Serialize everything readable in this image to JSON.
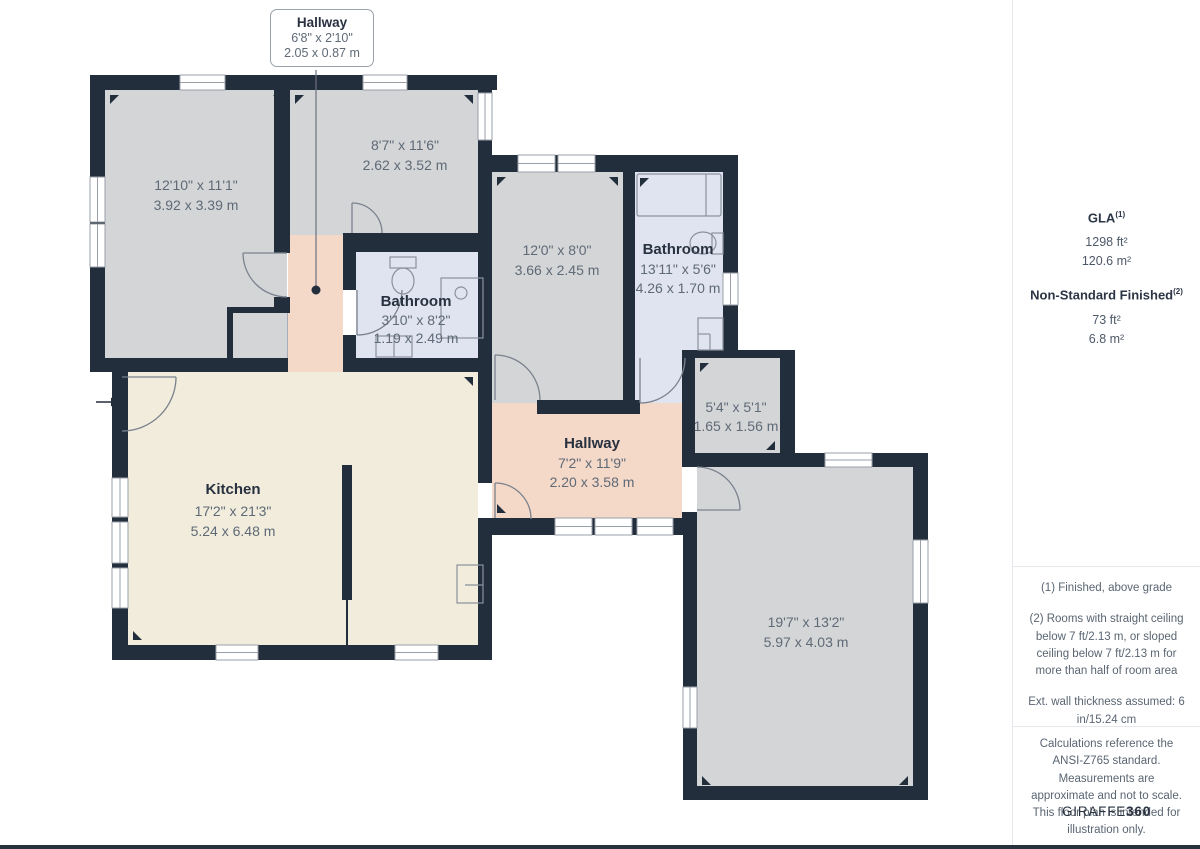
{
  "callout": {
    "name": "Hallway",
    "imperial": "6'8\" x 2'10\"",
    "metric": "2.05 x 0.87 m"
  },
  "rooms": [
    {
      "id": "room-top-left",
      "name": "",
      "imperial": "12'10\" x 11'1\"",
      "metric": "3.92 x 3.39 m"
    },
    {
      "id": "room-top-middle",
      "name": "",
      "imperial": "8'7\" x 11'6\"",
      "metric": "2.62 x 3.52 m"
    },
    {
      "id": "room-middle",
      "name": "",
      "imperial": "12'0\" x 8'0\"",
      "metric": "3.66 x 2.45 m"
    },
    {
      "id": "bathroom-large",
      "name": "Bathroom",
      "imperial": "13'11\" x 5'6\"",
      "metric": "4.26 x 1.70 m"
    },
    {
      "id": "bathroom-small",
      "name": "Bathroom",
      "imperial": "3'10\" x 8'2\"",
      "metric": "1.19 x 2.49 m"
    },
    {
      "id": "storage",
      "name": "",
      "imperial": "5'4\" x 5'1\"",
      "metric": "1.65 x 1.56 m"
    },
    {
      "id": "kitchen",
      "name": "Kitchen",
      "imperial": "17'2\" x 21'3\"",
      "metric": "5.24 x 6.48 m"
    },
    {
      "id": "hallway-main",
      "name": "Hallway",
      "imperial": "7'2\" x 11'9\"",
      "metric": "2.20 x 3.58 m"
    },
    {
      "id": "room-bottom-right",
      "name": "",
      "imperial": "19'7\" x 13'2\"",
      "metric": "5.97 x 4.03 m"
    }
  ],
  "sidebar": {
    "gla": {
      "label": "GLA",
      "sup": "(1)",
      "values": [
        "1298 ft²",
        "120.6 m²"
      ]
    },
    "nsf": {
      "label": "Non-Standard Finished",
      "sup": "(2)",
      "values": [
        "73 ft²",
        "6.8 m²"
      ]
    },
    "notes": [
      "(1) Finished, above grade",
      "(2) Rooms with straight ceiling below 7 ft/2.13 m, or sloped ceiling below 7 ft/2.13 m for more than half of room area",
      "Ext. wall thickness assumed: 6 in/15.24 cm"
    ],
    "disclaimer": "Calculations reference the ANSI-Z765 standard. Measurements are approximate and not to scale. This floor plan is intended for illustration only.",
    "logo": {
      "text": "GIRAFFE",
      "bold": "360"
    }
  },
  "colors": {
    "wall": "#232e3c",
    "room_gray": "#d4d5d7",
    "kitchen_cream": "#f1ecdb",
    "hallway_pink": "#f4d8c8",
    "bathroom_blue": "#dfe4f0",
    "dim_text": "#5f6a77",
    "title_text": "#28313f"
  }
}
